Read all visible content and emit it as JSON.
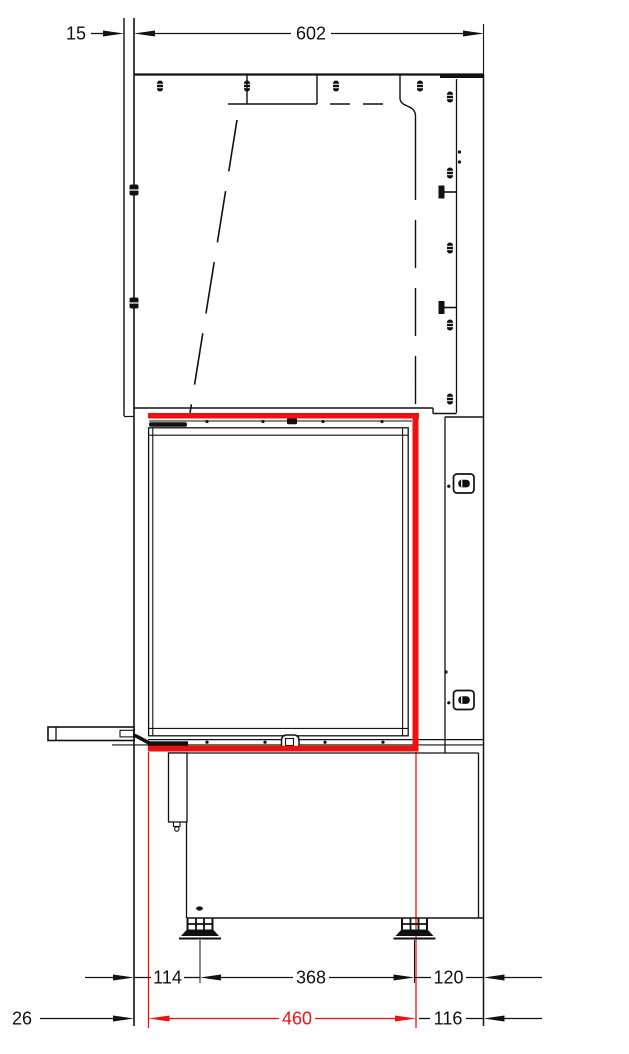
{
  "colors": {
    "line": "#111111",
    "highlight_red": "#ee1111"
  },
  "dimensions": {
    "top": [
      {
        "id": "wall-offset",
        "label": "15"
      },
      {
        "id": "body-depth",
        "label": "602"
      }
    ],
    "feet_row": [
      {
        "id": "front-to-foot",
        "label": "114"
      },
      {
        "id": "foot-spacing",
        "label": "368"
      },
      {
        "id": "foot-to-back",
        "label": "120"
      }
    ],
    "opening_row": [
      {
        "id": "front-offset",
        "label": "26"
      },
      {
        "id": "opening-depth",
        "label": "460"
      },
      {
        "id": "opening-to-back",
        "label": "116"
      }
    ]
  }
}
